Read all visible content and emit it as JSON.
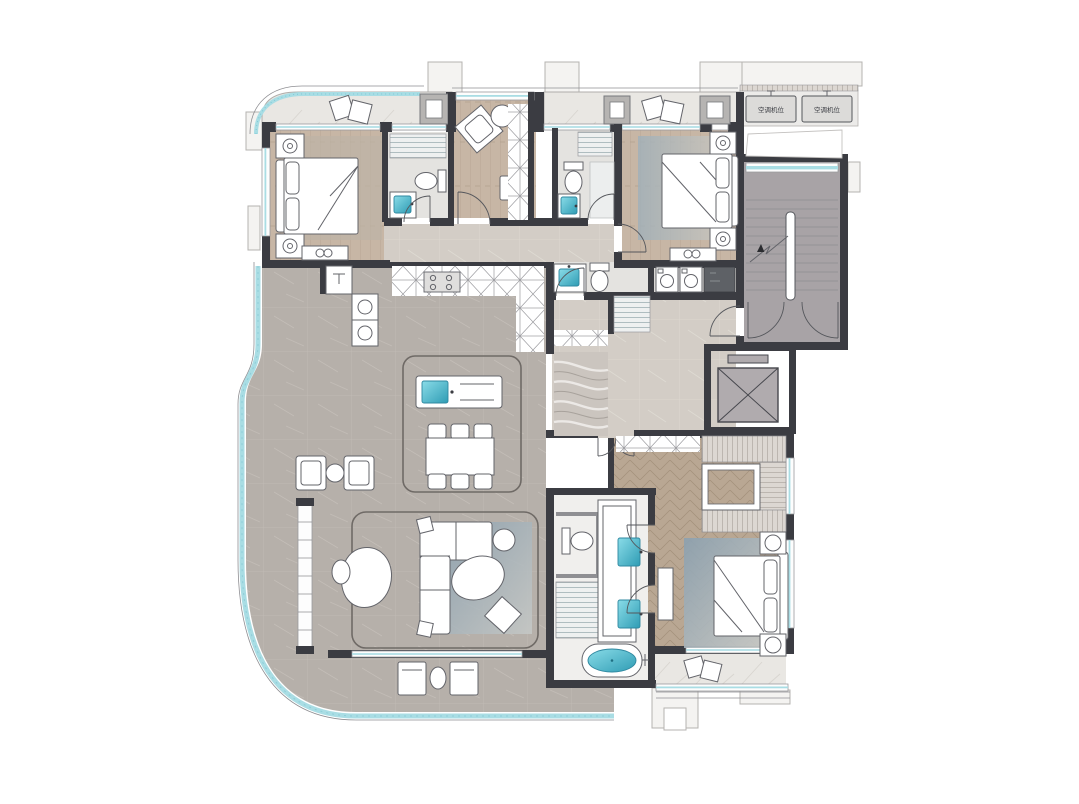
{
  "labels": {
    "ac_unit_left": "空调机位",
    "ac_unit_right": "空调机位"
  },
  "palette": {
    "wall": "#3b3c42",
    "wall2": "#8f8f93",
    "line": "#63646a",
    "wood": "#c7b6a5",
    "woodLine": "#b2a08e",
    "herring": "#b9a793",
    "herringLine": "#a38f7a",
    "marbleGray": "#b6b0aa",
    "marbleGrayLine": "#c6c0ba",
    "marbleLight": "#e9e7e3",
    "beige": "#d3cdc6",
    "tile": "#e4e3e0",
    "stair": "#a8a3a6",
    "teal": "#5fc4d6",
    "tealBand": "#a9dde4",
    "rugBlue": "#96a9b5",
    "cabinet": "#f7f6f5"
  },
  "plan": {
    "type": "residential-floor-plan",
    "rooms": [
      {
        "id": "balcony-north",
        "floor": "marble-light"
      },
      {
        "id": "bedroom-2",
        "floor": "wood-plank"
      },
      {
        "id": "bath-2",
        "floor": "tile"
      },
      {
        "id": "study",
        "floor": "wood-plank"
      },
      {
        "id": "bath-3",
        "floor": "tile"
      },
      {
        "id": "bedroom-3",
        "floor": "wood-plank"
      },
      {
        "id": "laundry",
        "floor": "tile"
      },
      {
        "id": "bath-4",
        "floor": "tile"
      },
      {
        "id": "kitchen-dining-living",
        "floor": "marble-gray"
      },
      {
        "id": "foyer",
        "floor": "marble-beige"
      },
      {
        "id": "stairwell",
        "floor": "concrete"
      },
      {
        "id": "elevator",
        "floor": "concrete"
      },
      {
        "id": "walk-in-closet",
        "floor": "herringbone-wood"
      },
      {
        "id": "master-bedroom",
        "floor": "herringbone-wood"
      },
      {
        "id": "master-bath",
        "floor": "tile"
      },
      {
        "id": "balcony-south",
        "floor": "marble-gray"
      },
      {
        "id": "master-balcony",
        "floor": "marble-light"
      },
      {
        "id": "ac-platform",
        "floor": "concrete"
      }
    ]
  }
}
